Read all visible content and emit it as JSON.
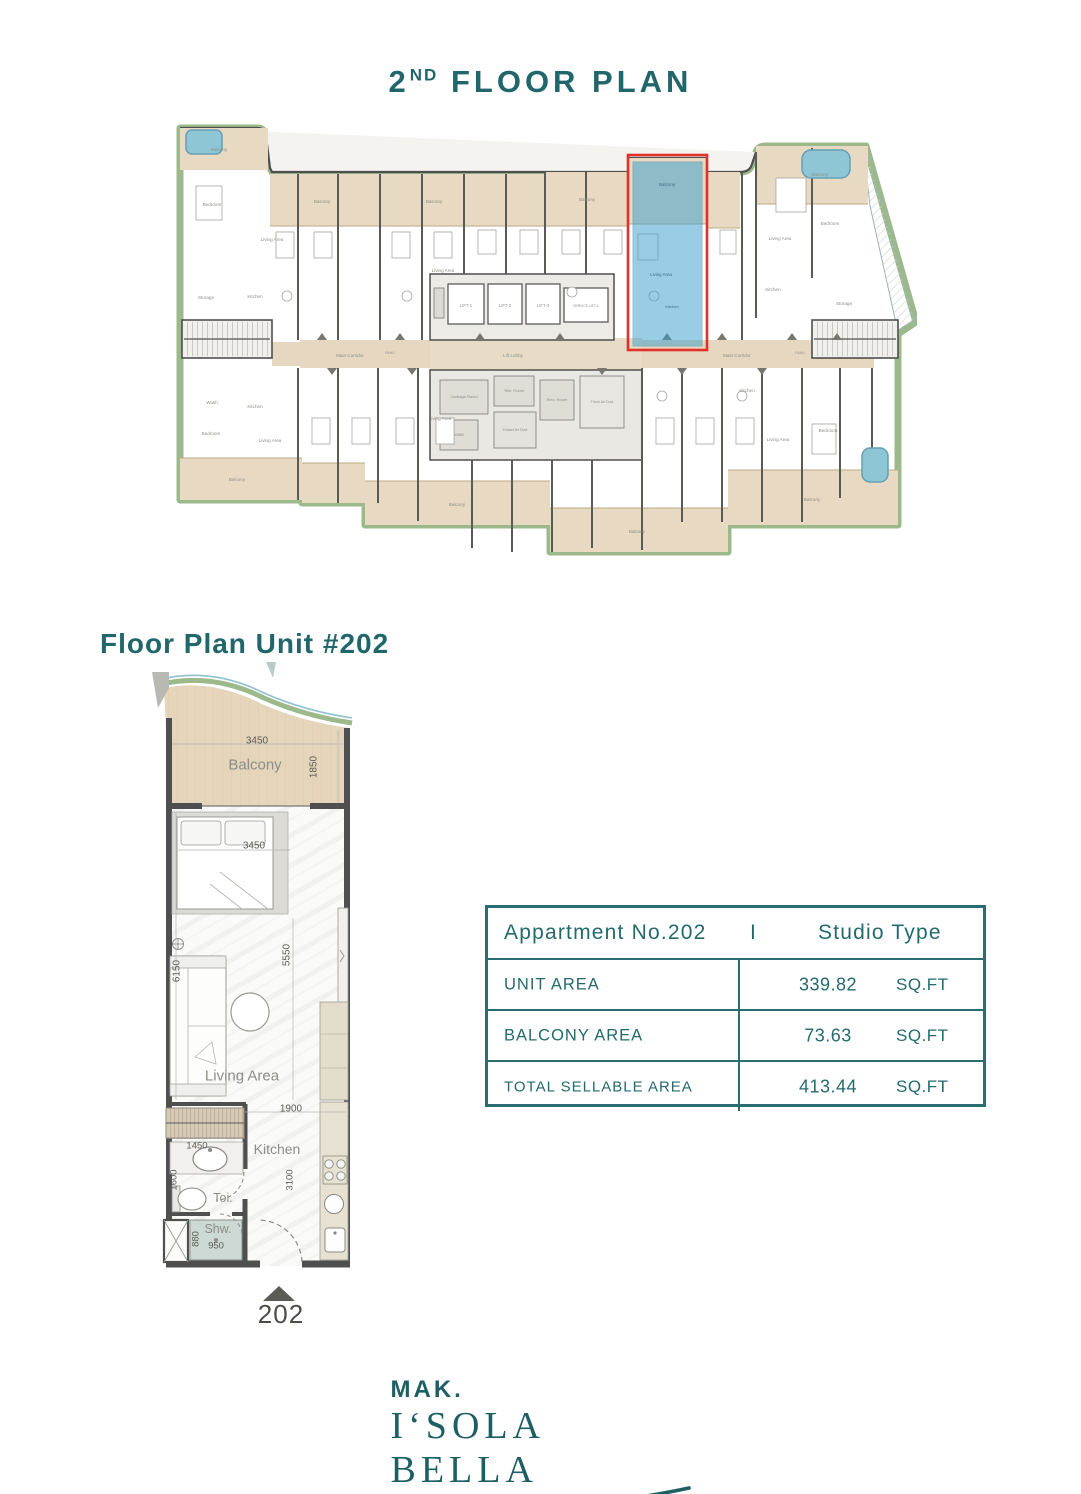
{
  "title": {
    "num": "2",
    "sup": "ND",
    "rest": " FLOOR PLAN"
  },
  "building": {
    "balcony": "Balcony",
    "bedroom": "Bedroom",
    "living": "Living Area",
    "kitchen": "Kitchen",
    "storage": "Storage",
    "wash": "Wash",
    "main_corridor": "Main Corridor",
    "lift_lobby": "Lift Lobby",
    "fahu": "FAHU",
    "lifts": [
      "LIFT-1",
      "LIFT-2",
      "LIFT-3",
      "SERVICE LIFT-1"
    ],
    "service_rooms": {
      "garbage": "Garbage Room",
      "tele": "Tele. Room",
      "elec": "Elec. Room",
      "fresh": "Fresh Air Duct",
      "extract": "Extract Air Duct",
      "wmb": "WMB"
    }
  },
  "unit": {
    "heading": "Floor Plan Unit #202",
    "number": "202",
    "rooms": {
      "balcony": "Balcony",
      "living": "Living Area",
      "kitchen": "Kitchen",
      "toilet": "Toi.",
      "shower": "Shw."
    },
    "dims": {
      "balcony_w": "3450",
      "balcony_d": "1850",
      "bed_w": "3450",
      "left_h": "6150",
      "inner_h": "5550",
      "kitchen_w": "1900",
      "vanity_w": "1450",
      "toilet_h": "1600",
      "kitchen_h": "3100",
      "shower_w": "950",
      "shower_h": "880"
    }
  },
  "table": {
    "header": {
      "left": "Appartment No.202",
      "separator": "I",
      "right": "Studio Type"
    },
    "rows": [
      {
        "label": "UNIT AREA",
        "value": "339.82",
        "unit": "SQ.FT"
      },
      {
        "label": "BALCONY AREA",
        "value": "73.63",
        "unit": "SQ.FT"
      },
      {
        "label": "TOTAL SELLABLE AREA",
        "value": "413.44",
        "unit": "SQ.FT"
      }
    ]
  },
  "logo": {
    "brand": "MAK.",
    "name": "I‘SOLA BELLA"
  },
  "colors": {
    "teal": "#21666a",
    "highlight": "#3da0cf",
    "highlight_border": "#e2302a"
  }
}
